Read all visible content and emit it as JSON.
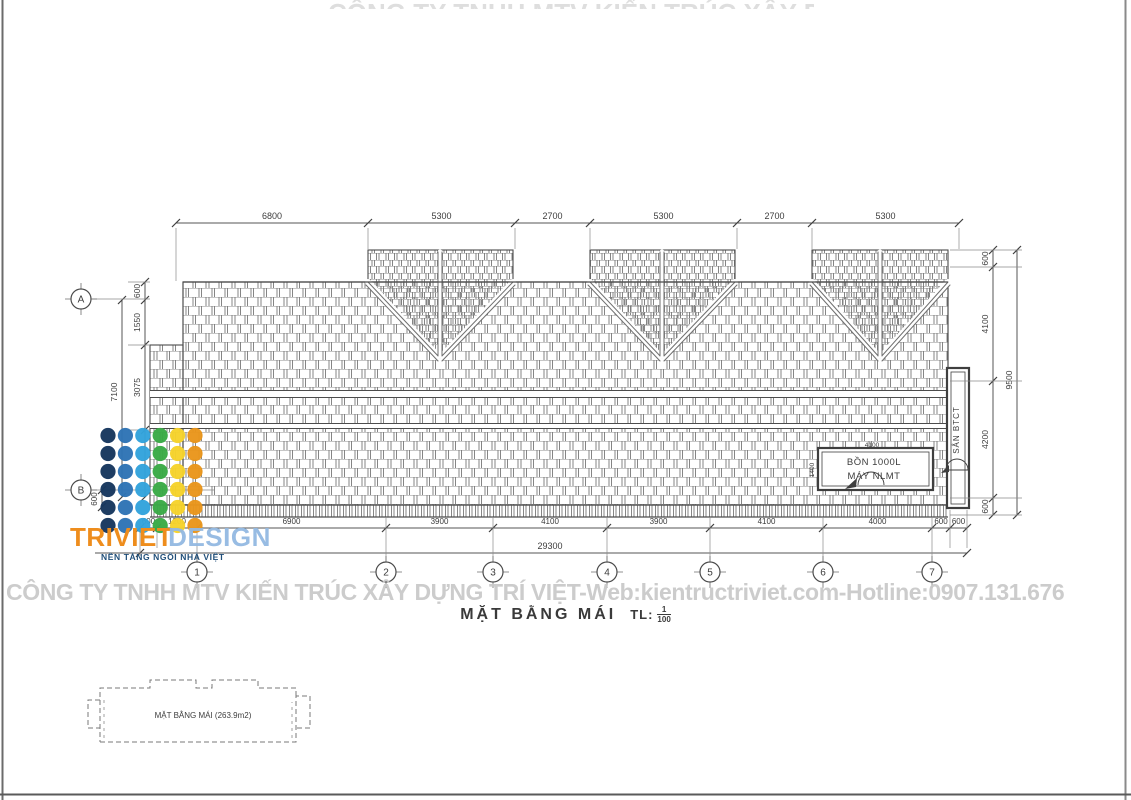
{
  "sheet": {
    "top_clipped_text": "CÔNG TY TNHH MTV KIẾN TRÚC XÂY DỰNG",
    "watermark": "CÔNG TY TNHH MTV KIẾN TRÚC XÂY DỰNG TRÍ VIỆT-Web:kientructriviet.com-Hotline:0907.131.676",
    "title": {
      "label": "MẶT BẰNG MÁI",
      "scale_prefix": "TL:",
      "scale_num": "1",
      "scale_den": "100"
    }
  },
  "logo": {
    "word1": "TRIVIET",
    "word2": "DESIGN",
    "tagline": "NỀN TẢNG NGÔI NHÀ VIỆT",
    "dot_colors": [
      "#17375e",
      "#2e74b5",
      "#33a3dc",
      "#3aaa46",
      "#f6d32b",
      "#e9961c"
    ],
    "dot_rows": 6
  },
  "plan": {
    "tank_label_line1": "BỒN 1000L",
    "tank_label_line2": "MÁY NLMT",
    "tank_dim_top": "4100",
    "tank_dim_left": "1400",
    "san_label": "SÂN BTCT"
  },
  "grid": {
    "rows": [
      "A",
      "B"
    ],
    "cols": [
      "1",
      "2",
      "3",
      "4",
      "5",
      "6",
      "7"
    ]
  },
  "dimensions": {
    "top": [
      "6800",
      "5300",
      "2700",
      "5300",
      "2700",
      "5300"
    ],
    "bottom": [
      "600",
      "1200",
      "6900",
      "3900",
      "4100",
      "3900",
      "4100",
      "4000",
      "600",
      "600"
    ],
    "bottom_total": "29300",
    "left": [
      "600",
      "1550",
      "3075"
    ],
    "left_total": "7100",
    "left_b": "600",
    "right": [
      "600",
      "4100",
      "4200",
      "600"
    ],
    "right_total": "9500"
  },
  "keyplan": {
    "label": "MẶT BẰNG MÁI (263.9m2)"
  }
}
